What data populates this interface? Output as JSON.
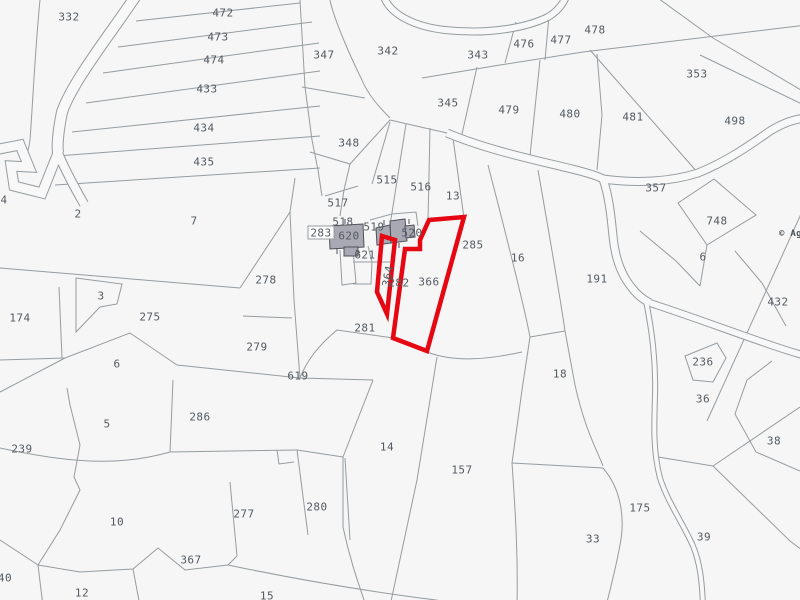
{
  "map": {
    "title": "cadastral-parcel-map",
    "background_color": "#f5f6f5",
    "boundary_color": "#979ca1",
    "road_fill_color": "#f7f8f7",
    "label_color": "#545a62",
    "highlight_color": "#e60713",
    "building_fill": "#a8a9b3",
    "building_stroke": "#50505a",
    "copyright": {
      "text": "© Age",
      "x": 779,
      "y": 234
    },
    "parcel_labels": [
      {
        "t": "332",
        "x": 69,
        "y": 17
      },
      {
        "t": "472",
        "x": 223,
        "y": 13
      },
      {
        "t": "473",
        "x": 218,
        "y": 37
      },
      {
        "t": "474",
        "x": 214,
        "y": 60
      },
      {
        "t": "433",
        "x": 207,
        "y": 89
      },
      {
        "t": "434",
        "x": 204,
        "y": 128
      },
      {
        "t": "435",
        "x": 204,
        "y": 162
      },
      {
        "t": "347",
        "x": 324,
        "y": 55
      },
      {
        "t": "342",
        "x": 388,
        "y": 51
      },
      {
        "t": "343",
        "x": 478,
        "y": 55
      },
      {
        "t": "476",
        "x": 524,
        "y": 44
      },
      {
        "t": "477",
        "x": 561,
        "y": 40
      },
      {
        "t": "478",
        "x": 595,
        "y": 30
      },
      {
        "t": "353",
        "x": 697,
        "y": 74
      },
      {
        "t": "345",
        "x": 448,
        "y": 103
      },
      {
        "t": "479",
        "x": 509,
        "y": 110
      },
      {
        "t": "480",
        "x": 570,
        "y": 114
      },
      {
        "t": "481",
        "x": 633,
        "y": 117
      },
      {
        "t": "498",
        "x": 735,
        "y": 121
      },
      {
        "t": "348",
        "x": 349,
        "y": 143
      },
      {
        "t": "515",
        "x": 387,
        "y": 180
      },
      {
        "t": "516",
        "x": 421,
        "y": 187
      },
      {
        "t": "13",
        "x": 453,
        "y": 196
      },
      {
        "t": "357",
        "x": 656,
        "y": 188
      },
      {
        "t": "748",
        "x": 717,
        "y": 221
      },
      {
        "t": "6",
        "x": 703,
        "y": 257
      },
      {
        "t": "517",
        "x": 338,
        "y": 203
      },
      {
        "t": "518",
        "x": 343,
        "y": 222
      },
      {
        "t": "519",
        "x": 374,
        "y": 227
      },
      {
        "t": "620",
        "x": 349,
        "y": 236
      },
      {
        "t": "520",
        "x": 412,
        "y": 233
      },
      {
        "t": "621",
        "x": 365,
        "y": 255
      },
      {
        "t": "285",
        "x": 473,
        "y": 245
      },
      {
        "t": "282",
        "x": 399,
        "y": 283
      },
      {
        "t": "366",
        "x": 429,
        "y": 282
      },
      {
        "t": "281",
        "x": 365,
        "y": 328
      },
      {
        "t": "16",
        "x": 518,
        "y": 258
      },
      {
        "t": "191",
        "x": 597,
        "y": 279
      },
      {
        "t": "432",
        "x": 778,
        "y": 302
      },
      {
        "t": "2",
        "x": 78,
        "y": 214
      },
      {
        "t": "7",
        "x": 194,
        "y": 221
      },
      {
        "t": "4",
        "x": 4,
        "y": 200
      },
      {
        "t": "3",
        "x": 101,
        "y": 296
      },
      {
        "t": "174",
        "x": 20,
        "y": 318
      },
      {
        "t": "275",
        "x": 150,
        "y": 317
      },
      {
        "t": "278",
        "x": 266,
        "y": 280
      },
      {
        "t": "279",
        "x": 257,
        "y": 347
      },
      {
        "t": "619",
        "x": 298,
        "y": 376
      },
      {
        "t": "6",
        "x": 117,
        "y": 364
      },
      {
        "t": "286",
        "x": 200,
        "y": 417
      },
      {
        "t": "5",
        "x": 107,
        "y": 424
      },
      {
        "t": "239",
        "x": 22,
        "y": 449
      },
      {
        "t": "10",
        "x": 117,
        "y": 522
      },
      {
        "t": "367",
        "x": 191,
        "y": 560
      },
      {
        "t": "277",
        "x": 244,
        "y": 514
      },
      {
        "t": "280",
        "x": 317,
        "y": 507
      },
      {
        "t": "12",
        "x": 82,
        "y": 593
      },
      {
        "t": "15",
        "x": 267,
        "y": 596
      },
      {
        "t": "40",
        "x": 5,
        "y": 578
      },
      {
        "t": "14",
        "x": 387,
        "y": 447
      },
      {
        "t": "157",
        "x": 462,
        "y": 470
      },
      {
        "t": "18",
        "x": 560,
        "y": 374
      },
      {
        "t": "33",
        "x": 593,
        "y": 539
      },
      {
        "t": "175",
        "x": 640,
        "y": 508
      },
      {
        "t": "36",
        "x": 703,
        "y": 399
      },
      {
        "t": "236",
        "x": 703,
        "y": 362
      },
      {
        "t": "38",
        "x": 774,
        "y": 441
      },
      {
        "t": "39",
        "x": 704,
        "y": 537
      }
    ],
    "rotated_labels": [
      {
        "t": "364",
        "x": 388,
        "y": 276,
        "rot": -80
      }
    ],
    "boxed_labels": [
      {
        "t": "283",
        "x": 321,
        "y": 233,
        "bx": 308,
        "by": 226,
        "bw": 26,
        "bh": 13
      }
    ],
    "highlight_parcels": [
      "364",
      "366"
    ],
    "highlight_paths": [
      "M382,236 L395,240 L387,314 L377,292 Z",
      "M429,220 L420,240 L420,249 L405,249 L393,338 L427,351 L464,217 Z"
    ],
    "roads": [
      {
        "d": "M137,-6 C115,28 73,80 62,112 C58,132 57,145 58,153",
        "w": 10
      },
      {
        "d": "M-6,150 L20,145 L29,167 L11,166 L14,186 L42,193 L58,153",
        "w": 9
      },
      {
        "d": "M58,153 C66,172 76,190 84,204",
        "w": 8
      },
      {
        "d": "M383,-6 C389,16 418,27 445,30 C490,35 528,27 548,17 C558,11 564,3 567,-6",
        "w": 6
      },
      {
        "d": "M447,133 C490,151 540,161 572,169 C588,173 598,176 603,179",
        "w": 7
      },
      {
        "d": "M603,179 C640,184 673,181 698,173 C728,161 753,143 770,131 C783,123 794,119 806,118",
        "w": 7
      },
      {
        "d": "M603,179 C609,196 611,216 613,236 C615,258 622,276 632,288 C638,296 644,300 650,303",
        "w": 7
      },
      {
        "d": "M650,303 C690,316 730,331 765,343 C785,350 795,353 806,356",
        "w": 6
      },
      {
        "d": "M646,301 C652,331 656,361 655,396 C654,426 653,451 660,478 C668,503 684,525 693,546 C700,563 702,581 703,606",
        "w": 4
      }
    ],
    "boundaries": [
      "M136,21 L300,3",
      "M118,47 L312,22",
      "M103,73 L319,43",
      "M86,103 L320,71",
      "M72,132 L320,106",
      "M57,156 L320,136",
      "M55,185 L320,168",
      "M300,0 L305,87 L312,140 L318,170",
      "M40,0 C35,50 33,100 30,140 C28,158 20,168 12,170",
      "M302,87 L365,98",
      "M330,0 C334,20 352,60 362,80 C368,95 380,108 390,118",
      "M310,152 L350,164 L390,120",
      "M390,120 L447,133",
      "M350,164 L344,190 L340,216",
      "M390,122 L372,184",
      "M406,124 L388,238",
      "M430,128 L428,221",
      "M452,131 L464,218",
      "M422,78 L500,65 L583,52 L806,25",
      "M516,22 L505,63",
      "M549,16 L545,60",
      "M477,67 L460,143",
      "M540,60 L530,156",
      "M597,54 L602,115 L597,170",
      "M590,50 L698,173",
      "M655,-4 L713,38 L806,93",
      "M700,55 L806,106",
      "M714,179 L678,203 L707,245 L756,215 Z",
      "M640,231 L676,261 L700,286",
      "M707,245 L700,286",
      "M735,251 L762,283 L786,326",
      "M806,203 L707,421",
      "M685,356 L717,343 L726,358 L713,382 L693,380 Z",
      "M747,380 L735,414 L756,452 L800,471",
      "M713,466 L800,407",
      "M713,466 L790,541 L806,553",
      "M658,457 L713,466",
      "M747,380 L772,361",
      "M488,165 C510,250 525,310 530,337 L522,390 L512,463 C516,520 518,560 517,606",
      "M538,170 C552,250 562,310 565,331 L575,385 C585,430 597,450 603,466",
      "M530,337 L565,331",
      "M512,463 L603,468",
      "M603,468 C622,490 625,520 620,545 C615,572 610,590 606,606",
      "M393,338 L337,330 C315,348 305,365 300,378",
      "M427,352 C455,363 490,359 522,352",
      "M300,378 L373,380",
      "M373,380 L343,457",
      "M343,457 L343,527 C350,560 358,582 366,606",
      "M437,357 L417,480 L390,606",
      "M0,268 L240,288",
      "M240,288 L290,212 L295,178",
      "M290,212 L294,300 L300,378",
      "M243,316 L292,318",
      "M59,287 L62,358",
      "M76,278 L122,284 L117,304 L100,307 L76,332 Z",
      "M0,360 L65,358 L130,333 L177,365",
      "M177,365 L300,378",
      "M0,392 L65,358",
      "M67,388 L70,405 L80,445 L74,477 L80,490 L60,530 L38,565",
      "M173,380 L170,452",
      "M0,448 C60,461 115,468 170,452",
      "M170,452 L297,450",
      "M277,450 L279,464 L294,462",
      "M230,482 L237,556",
      "M297,450 L308,535",
      "M345,458 L350,540",
      "M297,450 L343,457",
      "M38,565 L80,572 L133,569 L158,548 L185,570 L228,565",
      "M228,565 L237,556",
      "M228,565 C290,578 360,590 420,598 C445,601 458,603 470,608",
      "M38,565 L43,606",
      "M133,569 L140,606",
      "M0,540 L38,565",
      "M370,220 L392,214 L416,212 L418,226",
      "M368,246 L372,262 L390,262",
      "M340,250 L342,285 L356,283 L353,250",
      "M353,262 L372,262 L371,284 L353,284",
      "M325,196 L358,186",
      "M318,170 L322,196"
    ],
    "buildings": [
      "M329,226 L363,224 L364,247 L330,249 Z",
      "M344,247 L358,247 L358,256 L344,256 Z",
      "M376,228 L390,225 L391,243 L377,245 Z",
      "M390,221 L405,219 L407,241 L391,243 Z",
      "M405,226 L414,225 L415,237 L406,238 Z"
    ],
    "building_ticks": [
      "M345,224 L345,219",
      "M356,250 L360,253",
      "M384,225 L384,220",
      "M399,243 L399,248",
      "M409,224 L409,219",
      "M337,249 L337,254"
    ]
  }
}
